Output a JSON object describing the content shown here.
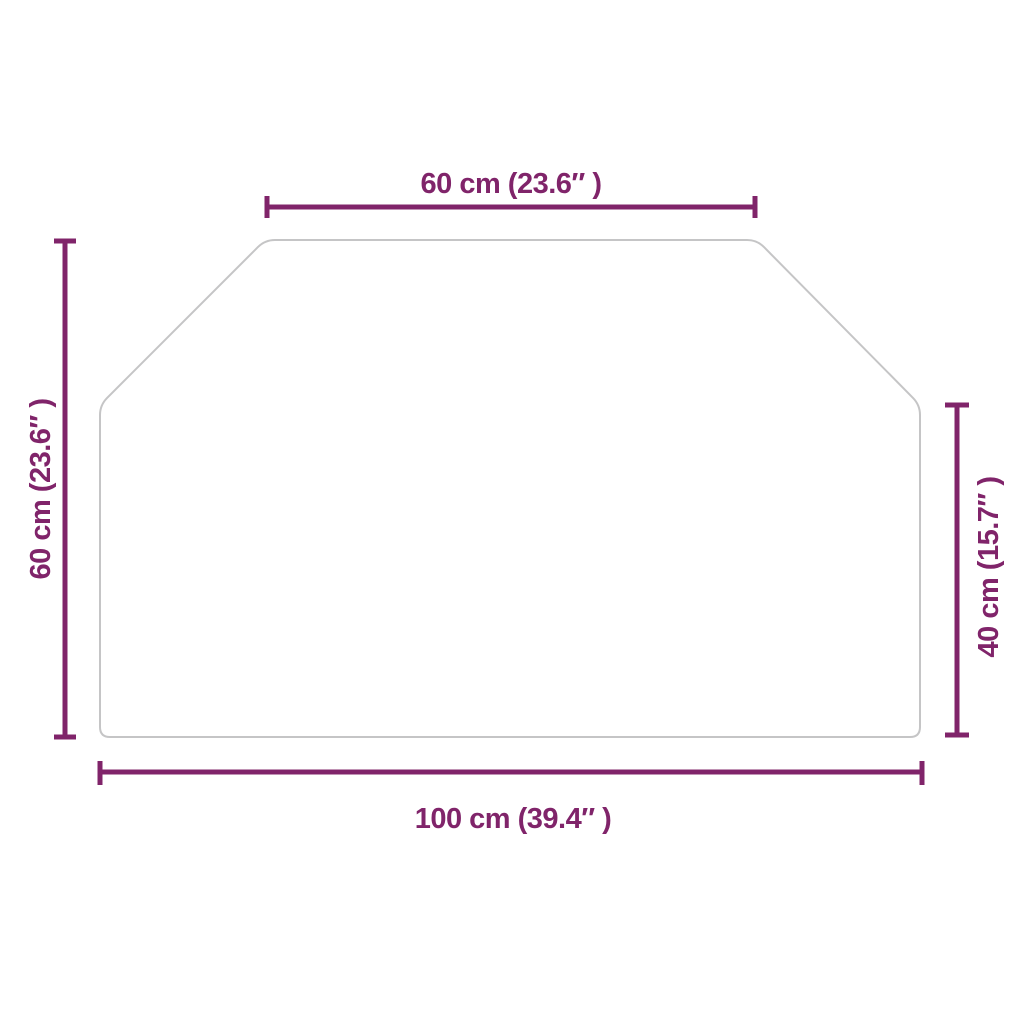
{
  "diagram_title": "hexagonal-glass-plate-dimension-drawing",
  "colors": {
    "dimension": "#80246a",
    "outline": "#c5c5c6",
    "background": "#ffffff"
  },
  "dimensions": {
    "top": {
      "label": "60 cm (23.6″ )",
      "value_cm": 60,
      "value_inch": 23.6
    },
    "left": {
      "label": "60 cm (23.6″ )",
      "value_cm": 60,
      "value_inch": 23.6
    },
    "right": {
      "label": "40 cm (15.7″ )",
      "value_cm": 40,
      "value_inch": 15.7
    },
    "bottom": {
      "label": "100 cm (39.4″ )",
      "value_cm": 100,
      "value_inch": 39.4
    }
  }
}
